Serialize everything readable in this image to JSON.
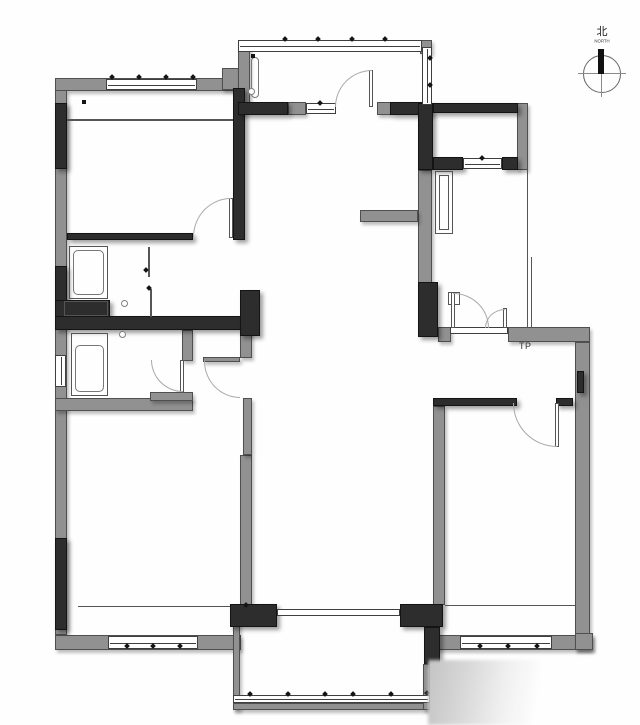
{
  "document": {
    "type": "residential-floor-plan"
  },
  "labels": {
    "tp": "TP",
    "compass_char": "北",
    "compass_word": "NORTH"
  },
  "colors": {
    "background": "#ffffff",
    "wall_gray": "#919191",
    "wall_black": "#2d2d2d",
    "line": "#555555",
    "door_arc": "#a9a9a9",
    "window_border": "#3f3f3f"
  },
  "icons": [
    {
      "name": "north-compass-icon",
      "description": "circle with cross lines, solid black needle pointing up"
    }
  ],
  "watermark": {
    "style": "soft gray gradient block, bottom right"
  }
}
